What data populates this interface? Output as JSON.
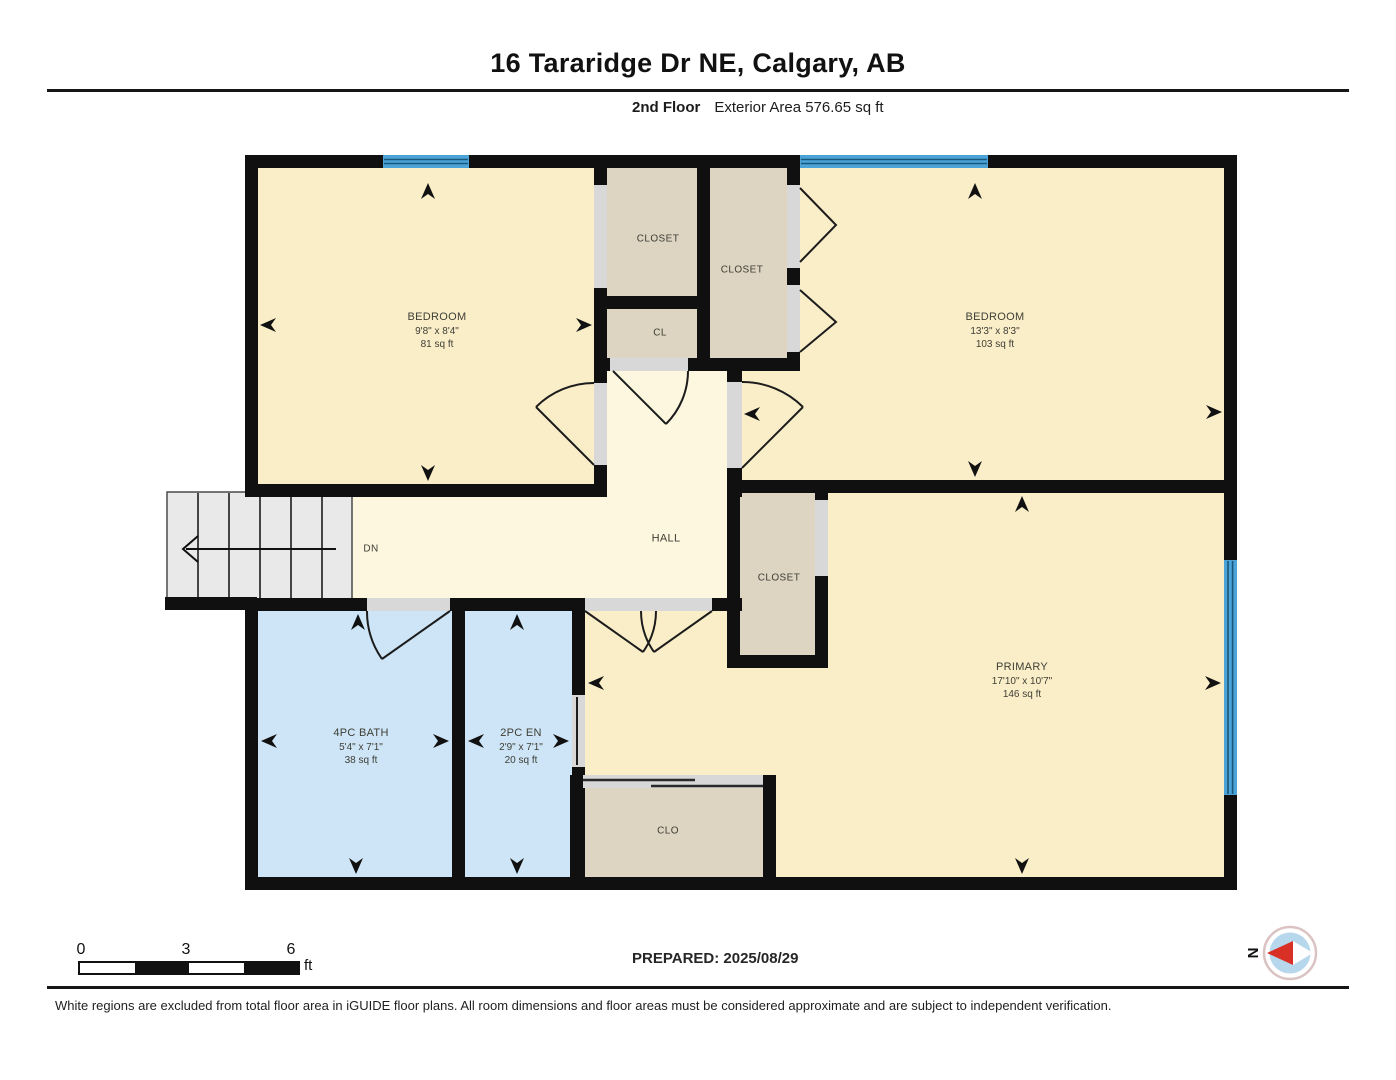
{
  "page": {
    "title": "16 Tararidge Dr NE, Calgary, AB",
    "subtitle": {
      "floor": "2nd Floor",
      "exterior_area": "Exterior Area 576.65 sq ft"
    },
    "prepared": "PREPARED: 2025/08/29",
    "disclaimer": "White regions are excluded from total floor area in iGUIDE floor plans. All room dimensions and floor areas must be considered approximate and are subject to independent verification.",
    "scale_bar": {
      "tick_0": "0",
      "tick_1": "3",
      "tick_2": "6",
      "unit": "ft"
    },
    "compass": {
      "north_label": "N"
    }
  },
  "rooms": {
    "bedroom_left": {
      "name": "BEDROOM",
      "dims": "9'8\" x 8'4\"",
      "area": "81 sq ft"
    },
    "bedroom_right": {
      "name": "BEDROOM",
      "dims": "13'3\" x 8'3\"",
      "area": "103 sq ft"
    },
    "primary": {
      "name": "PRIMARY",
      "dims": "17'10\" x 10'7\"",
      "area": "146 sq ft"
    },
    "bath": {
      "name": "4PC BATH",
      "dims": "5'4\" x 7'1\"",
      "area": "38 sq ft"
    },
    "ensuite": {
      "name": "2PC EN",
      "dims": "2'9\" x 7'1\"",
      "area": "20 sq ft"
    },
    "closet_top_left": {
      "name": "CLOSET"
    },
    "closet_top_right": {
      "name": "CLOSET"
    },
    "closet_small": {
      "name": "CL"
    },
    "closet_primary": {
      "name": "CLOSET"
    },
    "closet_bottom": {
      "name": "CLO"
    },
    "hall": {
      "name": "HALL"
    },
    "stairs": {
      "label": "DN"
    }
  },
  "colors": {
    "wall": "#101010",
    "room_fill": "#faeec9",
    "hall_fill": "#fdf7e0",
    "closet_fill": "#ddd4c2",
    "bath_fill": "#cde5f6",
    "window_blue": "#4ba3d8",
    "door_opening": "#d8d8d8",
    "stairs_fill": "#e9e9e9",
    "compass_red": "#d93025"
  }
}
